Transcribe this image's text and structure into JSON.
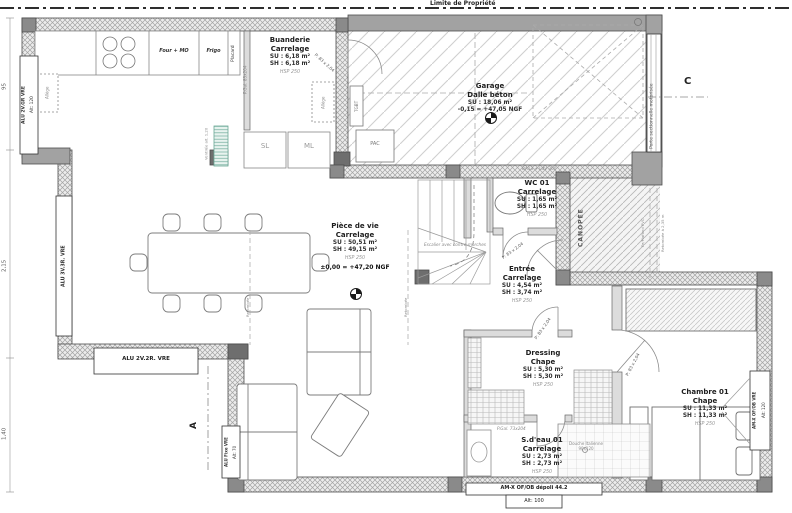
{
  "site": {
    "boundary": "Limite de Propriété"
  },
  "rooms": {
    "buanderie": {
      "name": "Buanderie",
      "finish": "Carrelage",
      "su": "SU : 6,18 m²",
      "sh": "SH : 6,18 m²",
      "hsp": "HSP 250"
    },
    "garage": {
      "name": "Garage",
      "finish": "Dalle béton",
      "su": "SU : 18,06 m²",
      "level": "-0,15 = +47,05 NGF"
    },
    "piece_de_vie": {
      "name": "Pièce de vie",
      "finish": "Carrelage",
      "su": "SU : 50,51 m²",
      "sh": "SH : 49,15 m²",
      "hsp": "HSP 250",
      "level": "±0,00 = +47,20 NGF"
    },
    "wc01": {
      "name": "WC 01",
      "finish": "Carrelage",
      "su": "SU : 1,65 m²",
      "sh": "SH : 1,65 m²",
      "hsp": "HSP 250"
    },
    "entree": {
      "name": "Entrée",
      "finish": "Carrelage",
      "su": "SU : 4,54 m²",
      "sh": "SH : 3,74 m²",
      "hsp": "HSP 250"
    },
    "dressing": {
      "name": "Dressing",
      "finish": "Chape",
      "su": "SU : 5,30 m²",
      "sh": "SH : 5,30 m²",
      "hsp": "HSP 250"
    },
    "chambre01": {
      "name": "Chambre 01",
      "finish": "Chape",
      "su": "SU : 11,33 m²",
      "sh": "SH : 11,33 m²",
      "hsp": "HSP 250"
    },
    "sdeau01": {
      "name": "S.d'eau 01",
      "finish": "Carrelage",
      "su": "SU : 2,73 m²",
      "sh": "SH : 2,73 m²",
      "hsp": "HSP 250"
    }
  },
  "windows": {
    "top_left": {
      "label": "ALU 2V.GR VRE",
      "alt": "Alt: 120"
    },
    "left": {
      "label": "ALU 3V.3R. VRE"
    },
    "bottom_left": {
      "label": "ALU 2V.2R. VRE"
    },
    "fixed": {
      "label": "ALU Fixe VRE",
      "alt": "Alt: 70"
    },
    "chambre": {
      "label": "AM-X OF/OB VRE",
      "alt": "Alt: 120"
    },
    "sdeau": {
      "label": "AM-X OF/OB dépoli 44.2",
      "alt": "Alt: 100"
    }
  },
  "doors": {
    "garage_door": "Porte sectionnelle motorisée",
    "kitchen": "P.Gal. 83x204",
    "buanderie": "P: 83 x 2,04",
    "wc": "P: 83 x 2,04",
    "entree": "P: 83 x 2,04",
    "chambre": "P: 83 x 2,04",
    "sdeau": "P.Gal. 73x204"
  },
  "kitchen": {
    "four": "Four + MO",
    "frigo": "Frigo",
    "placard": "Placard",
    "sl": "SL",
    "ml": "ML",
    "vent": "Ventilée alt. 1,20"
  },
  "equipment": {
    "pac": "PAC",
    "tgbt": "TGBT",
    "ba13": "BA13 + LdV 300",
    "stairs": "Escalier avec contre-marches",
    "douche": "Douche Italienne 90x120",
    "allege": "Allège"
  },
  "annotations": {
    "canopee": "CANOPÉE",
    "fe_plafond": "Fe/Plafond PVC",
    "retombee235": "Retombée à 2,35 m",
    "retombee": "Retombée"
  },
  "markers": {
    "a": "A",
    "c": "C"
  },
  "dimensions": {
    "top": "95",
    "middle": "2,15",
    "bottom": "1,40"
  }
}
